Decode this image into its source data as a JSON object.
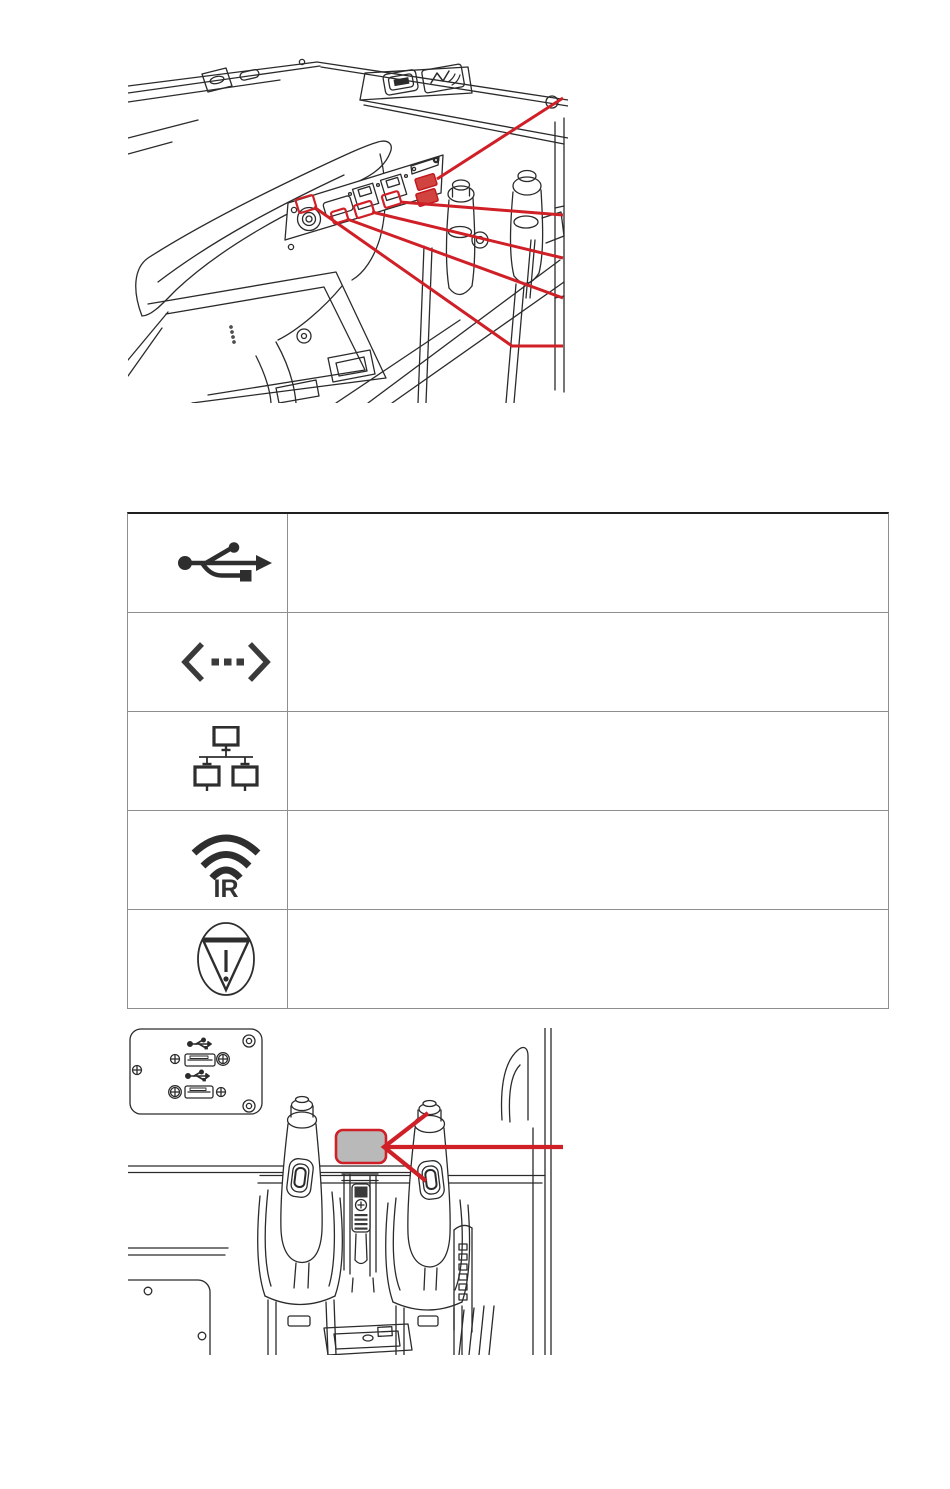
{
  "page": {
    "width": 950,
    "height": 1489,
    "background": "#ffffff"
  },
  "colors": {
    "callout_red": "#d02027",
    "port_highlight_fill": "#d0433e",
    "grey_label_fill": "#b9b9b9",
    "line_art": "#2b2b2b",
    "table_border": "#8e8e8e",
    "table_top_border": "#1f1f1f",
    "icon_ink": "#2e2e2e"
  },
  "figure_top": {
    "name": "console-armrest-connectivity-panel-figure",
    "callout_count": 5,
    "highlights": [
      "serial-usb-ports",
      "ethernet-port-2",
      "ethernet-port-1",
      "accessory-slot",
      "round-connector"
    ]
  },
  "symbols_table": {
    "rows": [
      {
        "icon": "usb-icon",
        "description": ""
      },
      {
        "icon": "bidirectional-arrow-icon",
        "description": ""
      },
      {
        "icon": "network-icon",
        "description": ""
      },
      {
        "icon": "infrared-icon",
        "ir_label": "IR",
        "description": ""
      },
      {
        "icon": "caution-stop-icon",
        "description": ""
      }
    ]
  },
  "figure_bottom": {
    "name": "console-grips-usb-panel-figure",
    "callout_count": 1,
    "highlights": [
      "grey-label-area"
    ]
  }
}
